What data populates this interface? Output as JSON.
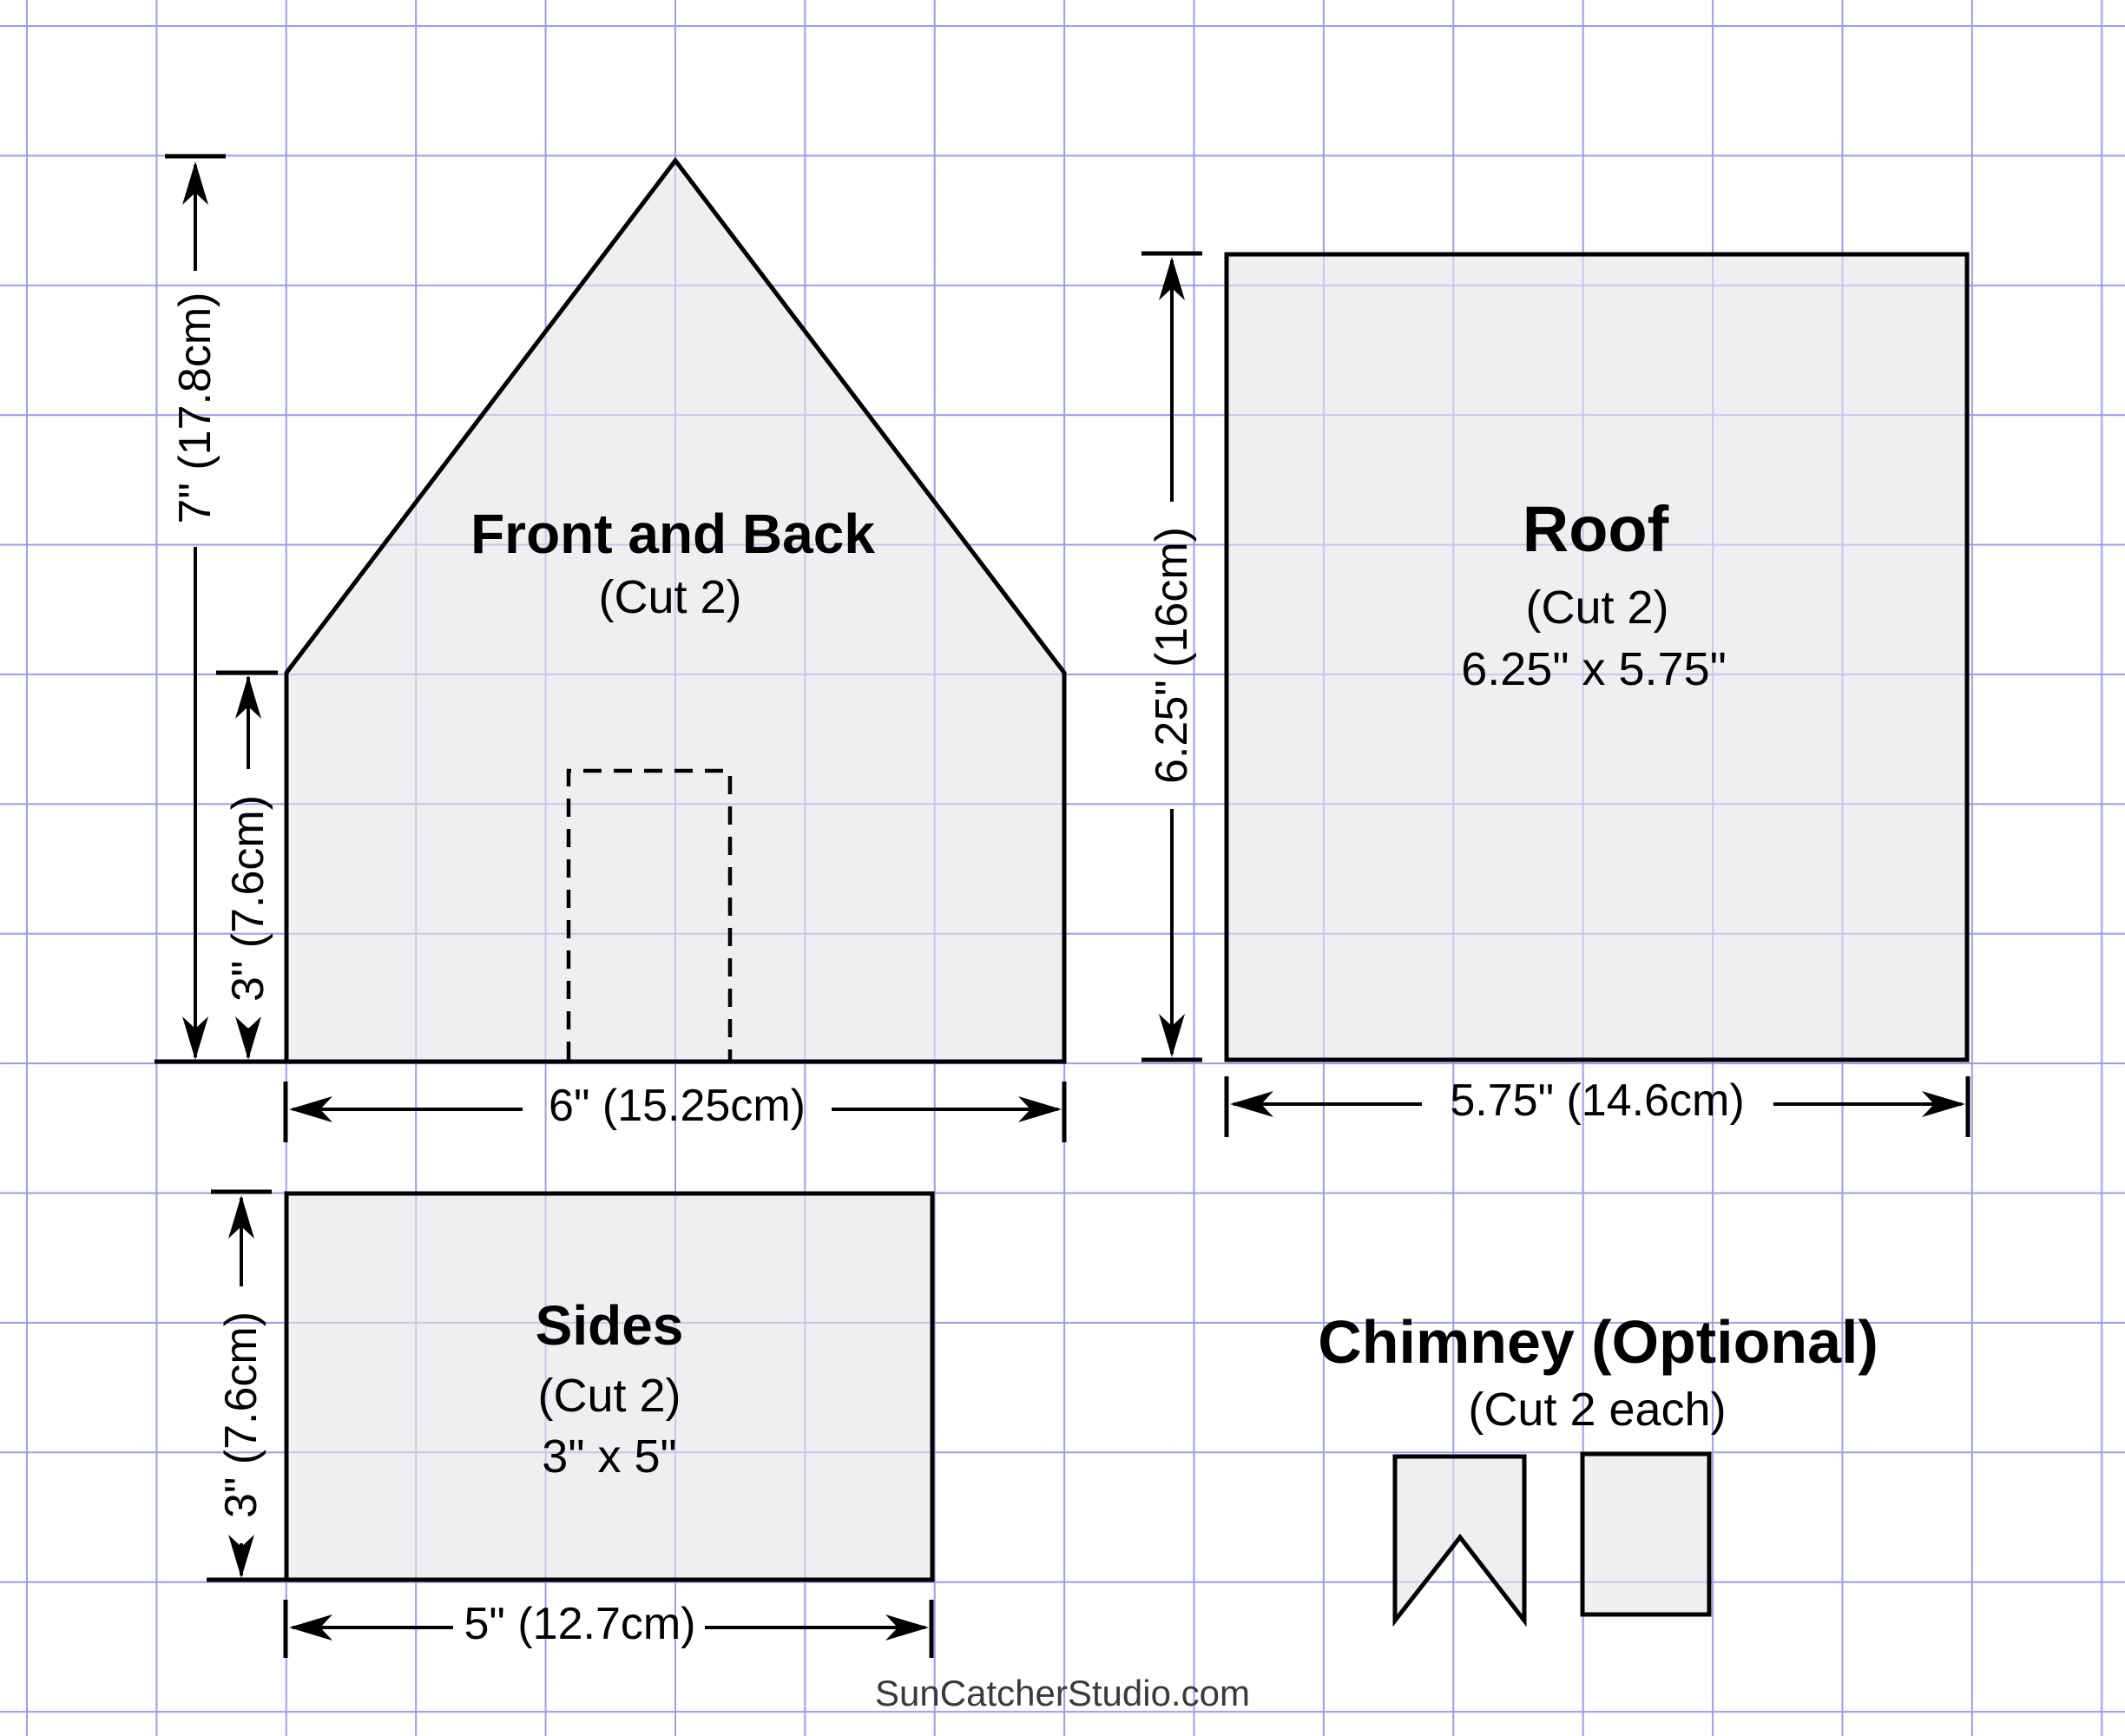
{
  "pieces": {
    "front_back": {
      "title": "Front and Back",
      "cut": "(Cut 2)"
    },
    "roof": {
      "title": "Roof",
      "cut": "(Cut 2)",
      "size": "6.25\" x 5.75\""
    },
    "sides": {
      "title": "Sides",
      "cut": "(Cut 2)",
      "size": "3\" x 5\""
    },
    "chimney": {
      "title": "Chimney (Optional)",
      "cut": "(Cut 2 each)"
    }
  },
  "dimensions": {
    "house_height": "7\" (17.8cm)",
    "house_wall": "3\" (7.6cm)",
    "house_width": "6\" (15.25cm)",
    "roof_height": "6.25\" (16cm)",
    "roof_width": "5.75\" (14.6cm)",
    "sides_height": "3\" (7.6cm)",
    "sides_width": "5\" (12.7cm)"
  },
  "watermark": "SunCatcherStudio.com",
  "colors": {
    "grid": "#9c9cf0",
    "piece_fill": "#ececec",
    "outline": "#000000"
  }
}
